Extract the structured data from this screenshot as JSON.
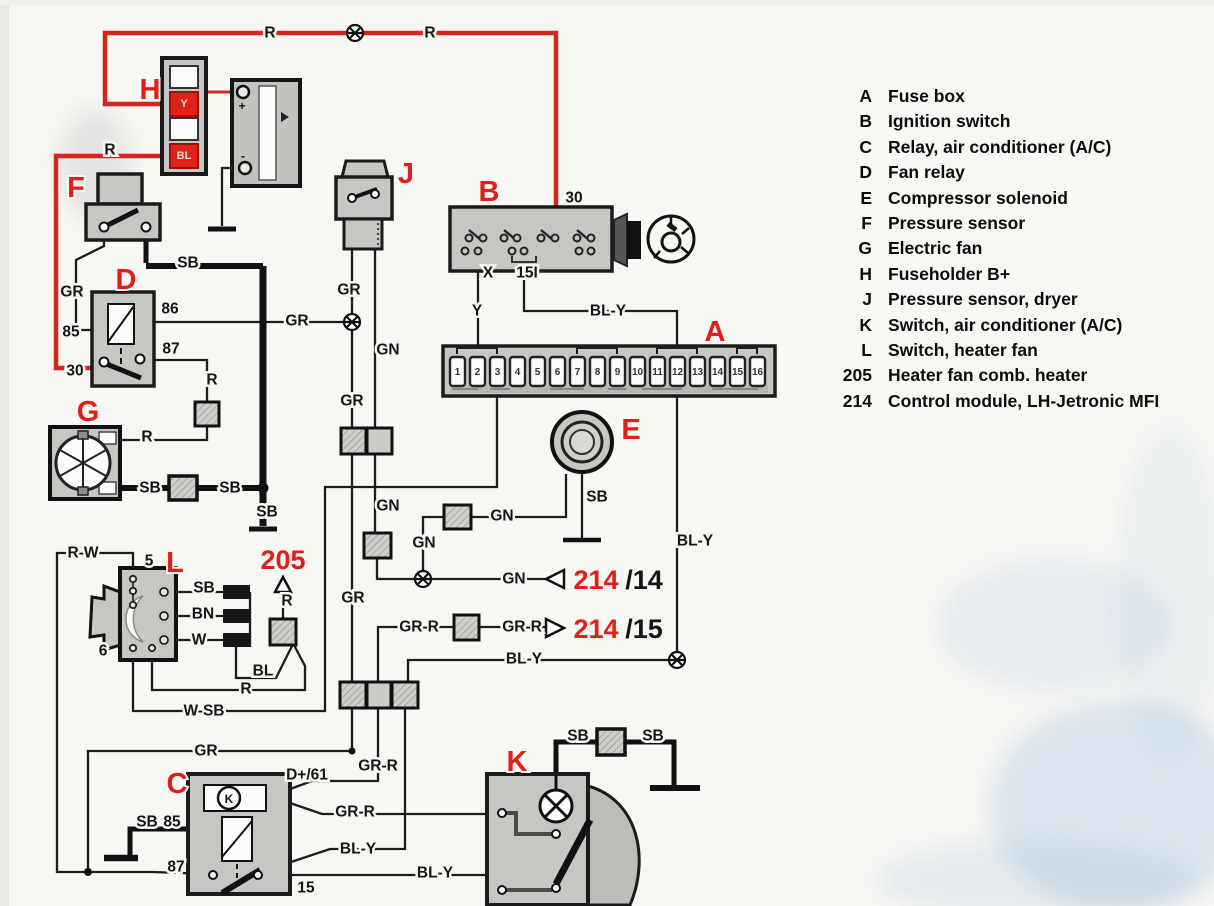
{
  "legend": {
    "items": [
      {
        "key": "A",
        "label": "Fuse box"
      },
      {
        "key": "B",
        "label": "Ignition switch"
      },
      {
        "key": "C",
        "label": "Relay, air conditioner (A/C)"
      },
      {
        "key": "D",
        "label": "Fan relay"
      },
      {
        "key": "E",
        "label": "Compressor solenoid"
      },
      {
        "key": "F",
        "label": "Pressure sensor"
      },
      {
        "key": "G",
        "label": "Electric fan"
      },
      {
        "key": "H",
        "label": "Fuseholder B+"
      },
      {
        "key": "J",
        "label": "Pressure sensor, dryer"
      },
      {
        "key": "K",
        "label": "Switch, air conditioner (A/C)"
      },
      {
        "key": "L",
        "label": "Switch, heater fan"
      },
      {
        "key": "205",
        "label": "Heater fan comb. heater"
      },
      {
        "key": "214",
        "label": "Control module, LH-Jetronic MFI"
      }
    ]
  },
  "diagram": {
    "colors": {
      "red": "#e02018",
      "black": "#1c1c1c",
      "component_grey": "#c6c6c3"
    },
    "component_labels": [
      {
        "t": "H",
        "x": 150,
        "y": 90
      },
      {
        "t": "F",
        "x": 76,
        "y": 188
      },
      {
        "t": "D",
        "x": 126,
        "y": 280
      },
      {
        "t": "G",
        "x": 88,
        "y": 412
      },
      {
        "t": "J",
        "x": 406,
        "y": 174
      },
      {
        "t": "B",
        "x": 489,
        "y": 192
      },
      {
        "t": "A",
        "x": 715,
        "y": 332
      },
      {
        "t": "E",
        "x": 631,
        "y": 430
      },
      {
        "t": "L",
        "x": 175,
        "y": 563
      },
      {
        "t": "C",
        "x": 177,
        "y": 784
      },
      {
        "t": "K",
        "x": 517,
        "y": 762
      }
    ],
    "label_205": {
      "t": "205",
      "x": 283,
      "y": 560
    },
    "ref_labels": [
      {
        "red": "214",
        "black": "/14",
        "xr": 596,
        "xb": 644,
        "y": 580
      },
      {
        "red": "214",
        "black": "/15",
        "xr": 596,
        "xb": 644,
        "y": 629
      }
    ],
    "wire_labels": [
      {
        "t": "R",
        "x": 270,
        "y": 33
      },
      {
        "t": "R",
        "x": 430,
        "y": 33
      },
      {
        "t": "R",
        "x": 110,
        "y": 150
      },
      {
        "t": "30",
        "x": 574,
        "y": 198
      },
      {
        "t": "X",
        "x": 488,
        "y": 273
      },
      {
        "t": "15I",
        "x": 527,
        "y": 273
      },
      {
        "t": "Y",
        "x": 477,
        "y": 311
      },
      {
        "t": "BL-Y",
        "x": 608,
        "y": 311
      },
      {
        "t": "GR",
        "x": 72,
        "y": 292
      },
      {
        "t": "85",
        "x": 71,
        "y": 332
      },
      {
        "t": "86",
        "x": 170,
        "y": 309
      },
      {
        "t": "87",
        "x": 171,
        "y": 349
      },
      {
        "t": "30",
        "x": 75,
        "y": 371
      },
      {
        "t": "GR",
        "x": 297,
        "y": 321
      },
      {
        "t": "R",
        "x": 212,
        "y": 380
      },
      {
        "t": "R",
        "x": 147,
        "y": 437
      },
      {
        "t": "GR",
        "x": 349,
        "y": 290
      },
      {
        "t": "GN",
        "x": 388,
        "y": 350
      },
      {
        "t": "GR",
        "x": 352,
        "y": 401
      },
      {
        "t": "SB",
        "x": 188,
        "y": 263
      },
      {
        "t": "SB",
        "x": 150,
        "y": 488
      },
      {
        "t": "SB",
        "x": 230,
        "y": 488
      },
      {
        "t": "SB",
        "x": 267,
        "y": 512
      },
      {
        "t": "GN",
        "x": 388,
        "y": 506
      },
      {
        "t": "GN",
        "x": 424,
        "y": 543
      },
      {
        "t": "GN",
        "x": 502,
        "y": 516
      },
      {
        "t": "GN",
        "x": 514,
        "y": 579
      },
      {
        "t": "SB",
        "x": 597,
        "y": 497
      },
      {
        "t": "BL-Y",
        "x": 695,
        "y": 541
      },
      {
        "t": "R-W",
        "x": 83,
        "y": 553
      },
      {
        "t": "5",
        "x": 149,
        "y": 561
      },
      {
        "t": "6",
        "x": 103,
        "y": 651
      },
      {
        "t": "SB",
        "x": 204,
        "y": 588
      },
      {
        "t": "BN",
        "x": 203,
        "y": 614
      },
      {
        "t": "W",
        "x": 199,
        "y": 640
      },
      {
        "t": "BL",
        "x": 263,
        "y": 671
      },
      {
        "t": "R",
        "x": 287,
        "y": 601
      },
      {
        "t": "R",
        "x": 246,
        "y": 689
      },
      {
        "t": "W-SB",
        "x": 204,
        "y": 711
      },
      {
        "t": "GR",
        "x": 206,
        "y": 751
      },
      {
        "t": "GR-R",
        "x": 419,
        "y": 627
      },
      {
        "t": "GR-R",
        "x": 522,
        "y": 627
      },
      {
        "t": "BL-Y",
        "x": 524,
        "y": 659
      },
      {
        "t": "GR",
        "x": 353,
        "y": 598
      },
      {
        "t": "GR-R",
        "x": 378,
        "y": 766
      },
      {
        "t": "D+/61",
        "x": 307,
        "y": 775
      },
      {
        "t": "GR-R",
        "x": 355,
        "y": 812
      },
      {
        "t": "BL-Y",
        "x": 358,
        "y": 849
      },
      {
        "t": "BL-Y",
        "x": 435,
        "y": 873
      },
      {
        "t": "15",
        "x": 306,
        "y": 888
      },
      {
        "t": "85",
        "x": 172,
        "y": 822
      },
      {
        "t": "87",
        "x": 176,
        "y": 867
      },
      {
        "t": "SB",
        "x": 147,
        "y": 822
      },
      {
        "t": "SB",
        "x": 578,
        "y": 736
      },
      {
        "t": "SB",
        "x": 653,
        "y": 736
      }
    ],
    "tiny_labels": [
      {
        "t": "+",
        "x": 242,
        "y": 106
      },
      {
        "t": "-",
        "x": 243,
        "y": 156
      },
      {
        "t": "K",
        "x": 229,
        "y": 799
      }
    ],
    "fuseholder_fuse_labels": [
      {
        "t": "Y",
        "x": 184,
        "y": 104
      },
      {
        "t": "BL",
        "x": 184,
        "y": 156
      }
    ],
    "fuse_numbers": [
      "1",
      "2",
      "3",
      "4",
      "5",
      "6",
      "7",
      "8",
      "9",
      "10",
      "11",
      "12",
      "13",
      "14",
      "15",
      "16"
    ]
  }
}
